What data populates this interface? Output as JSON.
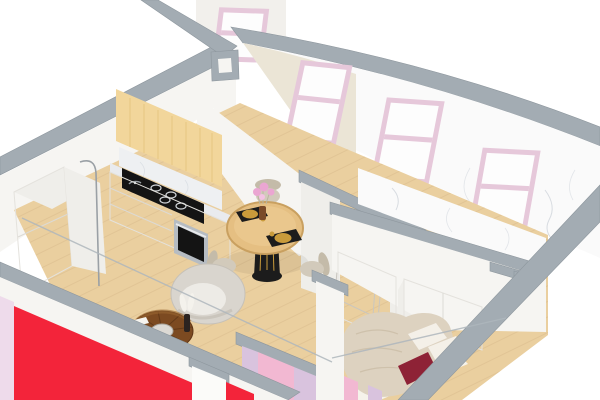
{
  "scene": {
    "type": "3d-isometric-apartment-cutaway-render",
    "description": "Isometric 3D cutaway render of a one-bedroom apartment with kitchen, living-dining area, hallway, bathroom and bedroom",
    "rooms": [
      "kitchen",
      "living-dining-area",
      "hallway",
      "bathroom",
      "bedroom"
    ],
    "window_count": 4,
    "objects": [
      "refrigerator-cabinet",
      "upper-cabinets-wood",
      "marble-backsplash",
      "induction-hob",
      "cooking-pot",
      "built-in-oven",
      "base-cabinets",
      "round-dining-table",
      "dining-chairs",
      "black-placemats",
      "gold-plates",
      "flower-vase",
      "barrel-armchair",
      "round-coffee-table",
      "floor-lamp",
      "open-doors",
      "wardrobe",
      "bathroom-cabinet",
      "double-bed",
      "white-pillows",
      "burgundy-accent-pillow",
      "pink-framed-windows",
      "red-cut-wall",
      "pink-cut-walls",
      "glass-balustrade",
      "marble-bathroom-wall"
    ],
    "colors": {
      "background": "#ffffff",
      "wall_cap": "#a3acb3",
      "wall_cap_dark": "#8e979e",
      "wall_white": "#f6f5f2",
      "wall_shaded": "#efeeea",
      "cream_wall": "#ebe5d6",
      "back_wall": "#f2f0ec",
      "red_wall": "#f3243a",
      "pink_wall": "#f2b8d2",
      "lavender_wall": "#d9c3de",
      "pink_sliver": "#eedbeb",
      "window_frame": "#e6c8da",
      "window_glass": "#fdfdfd",
      "bathroom_marble": "#fafafa",
      "marble_vein": "#c6ccd4",
      "floor_wood": "#eacf9f",
      "plank_line": "#d8bc8c",
      "cabinet_wood": "#f2d69b",
      "counter_marble": "#e9ebee",
      "backsplash_marble": "#eef0f2",
      "appliance_black": "#141414",
      "oven_steel": "#b6bcc2",
      "door_white": "#fbfbf9",
      "fridge_white": "#fafaf8",
      "wardrobe_white": "#f8f7f4",
      "armchair_gray": "#d9d5ce",
      "armchair_seat": "#edebe6",
      "coffee_table_wood": "#7c4a21",
      "coffee_table_rim": "#9a6630",
      "table_wood": "#e5bf82",
      "pedestal_black": "#1c1c1c",
      "gold": "#c99b3b",
      "chair_beige": "#d2cabb",
      "chair_beige_dark": "#c4bba9",
      "duvet_beige": "#ddd2c0",
      "pillow_white": "#f4f0e8",
      "pillow_burgundy": "#8e2236",
      "mattress_white": "#f5f2ea",
      "flower_pink": "#eba6d2",
      "glass_line": "#aeb6bc"
    }
  }
}
